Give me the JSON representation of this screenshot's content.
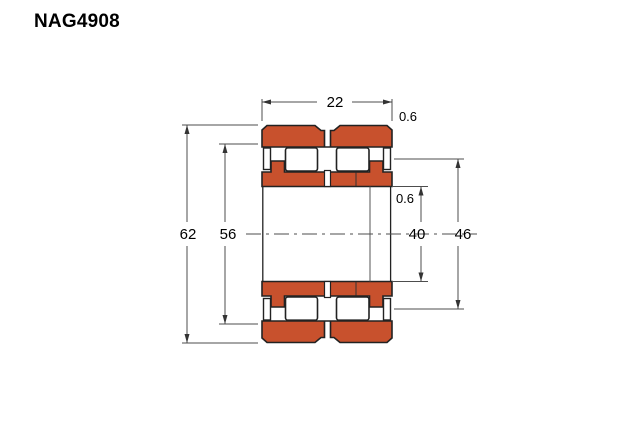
{
  "title": "NAG4908",
  "dims": {
    "width": "22",
    "outer_chamfer": "0.6",
    "outer_diameter": "62",
    "raceway_diameter": "56",
    "bore_diameter": "40",
    "bore_chamfer": "0.6",
    "rib_diameter": "46"
  },
  "colors": {
    "ring_fill": "#c8512d",
    "outline": "#222222",
    "dim_line": "#4d4d4d"
  }
}
